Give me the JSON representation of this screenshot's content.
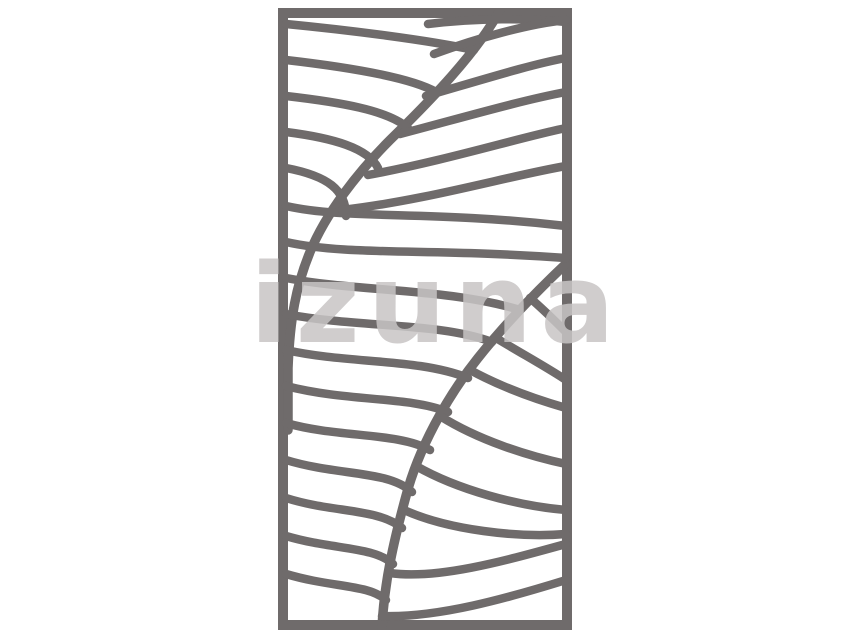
{
  "watermark": {
    "text": "izuna"
  },
  "colors": {
    "background": "#ffffff",
    "panel-line": "#6F6B6B",
    "watermark": "#C8C5C5"
  },
  "panel": {
    "name": "wavy-leaf-laser-cut-screen-panel"
  }
}
